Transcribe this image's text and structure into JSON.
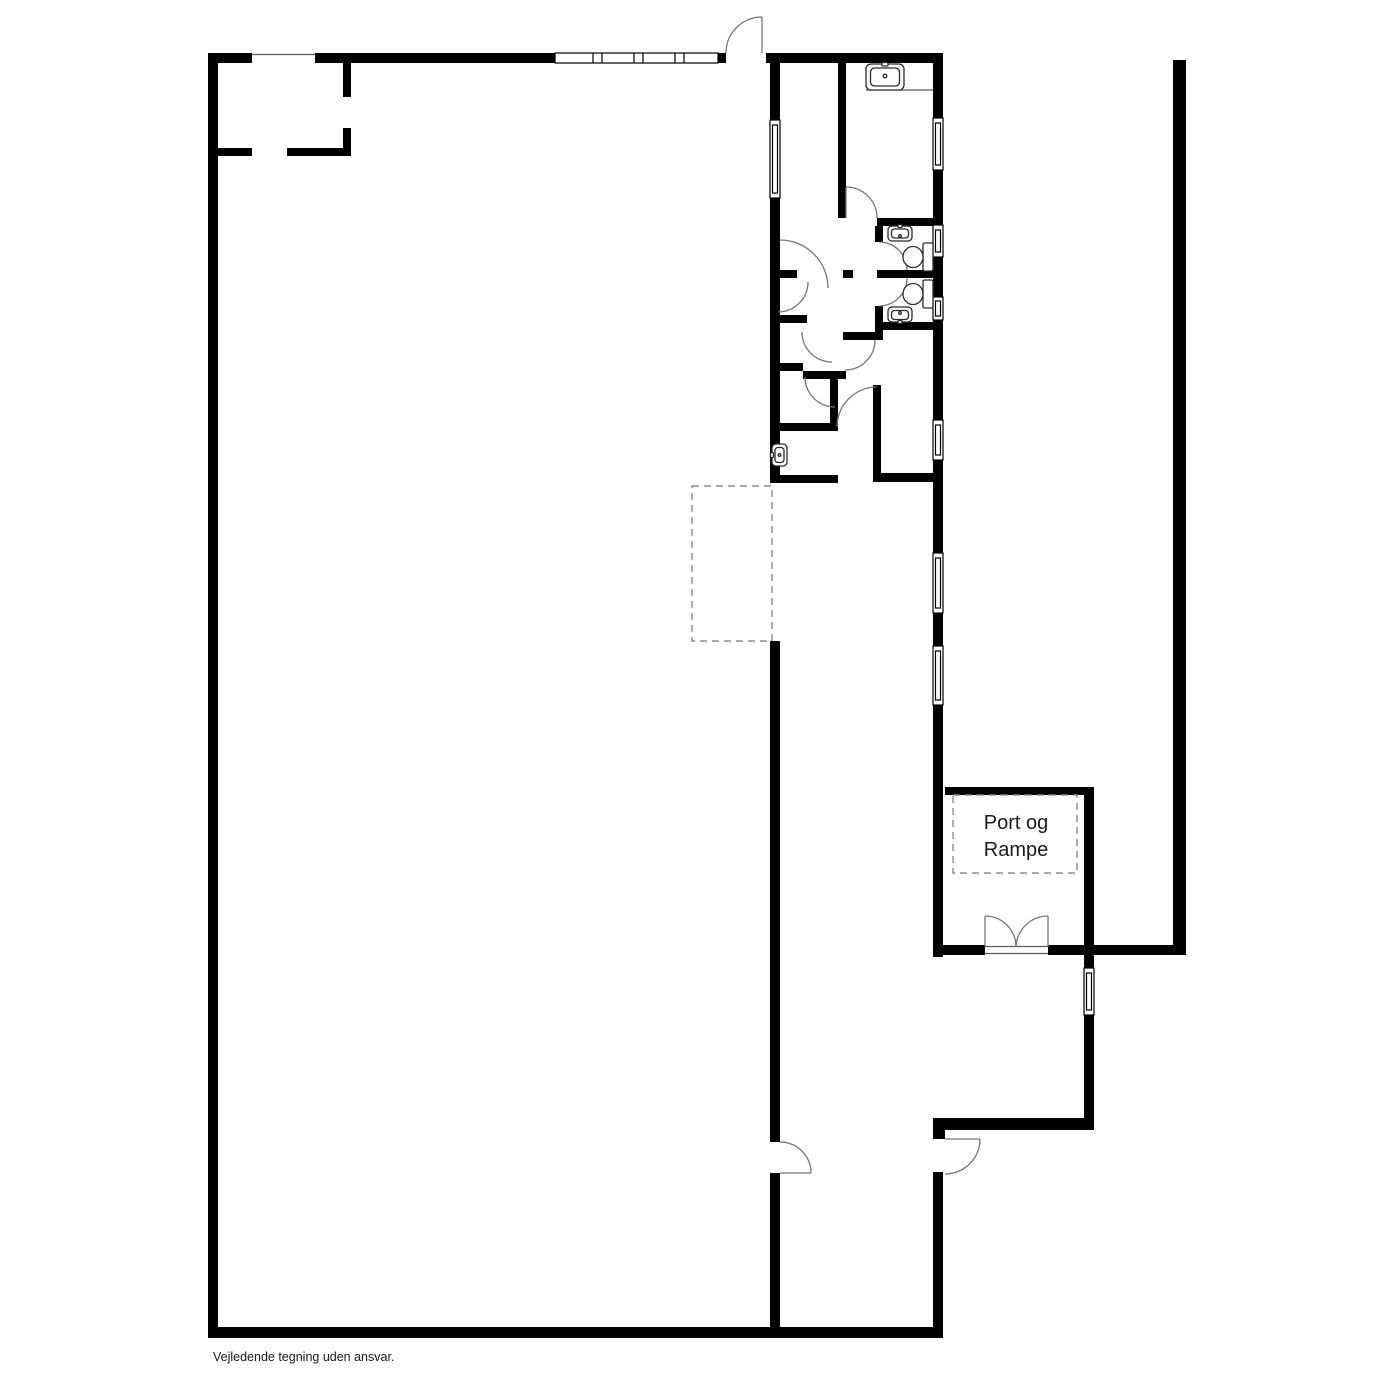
{
  "labels": {
    "port_room_line1": "Port og",
    "port_room_line2": "Rampe",
    "disclaimer": "Vejledende tegning uden ansvar."
  },
  "colors": {
    "background": "#ffffff",
    "wall": "#000000",
    "door_swing": "#757575",
    "dashed_zone": "#8a8a8a",
    "fixture": "#2a2a2a",
    "thin_line": "#5a5a5a",
    "text": "#1a1a1a"
  }
}
